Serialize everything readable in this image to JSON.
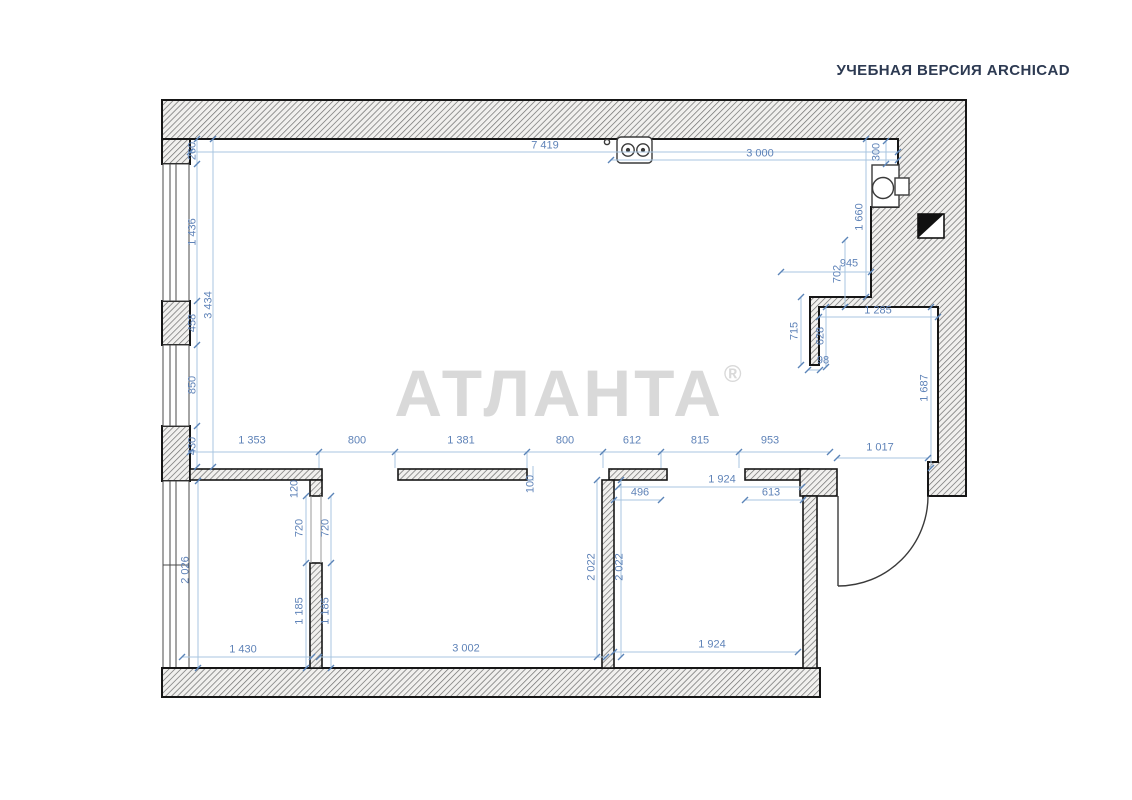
{
  "header": {
    "title": "УЧЕБНАЯ ВЕРСИЯ ARCHICAD"
  },
  "watermark": {
    "text": "АТЛАНТА",
    "mark": "®"
  },
  "colors": {
    "dimension_text": "#5f83b8",
    "dimension_line": "#a9c6e0",
    "wall_outline": "#161616",
    "hatch_line": "#6e6e6e",
    "header_text": "#2d3a52",
    "watermark_gray": "#d9d9d9"
  },
  "icons": {
    "stove": "stove-2-burner-icon",
    "boiler": "boiler-icon",
    "marker": "section-marker-icon",
    "door": "entry-door-arc"
  },
  "dims": {
    "d7419": "7 419",
    "d3000": "3 000",
    "d300": "300",
    "d260": "260",
    "d1436": "1 436",
    "d3434": "3 434",
    "d458": "458",
    "d850": "850",
    "d430": "430",
    "d1353": "1 353",
    "d800a": "800",
    "d1381": "1 381",
    "d800b": "800",
    "d612": "612",
    "d815": "815",
    "d953": "953",
    "d1017": "1 017",
    "d945": "945",
    "d702": "702",
    "d1660": "1 660",
    "d1285": "1 285",
    "d715": "715",
    "d628": "628",
    "d98": "98",
    "d1687": "1 687",
    "d120": "120",
    "d100": "100",
    "d720L": "720",
    "d720R": "720",
    "d1185L": "1 185",
    "d1185R": "1 185",
    "d2026": "2 026",
    "d1430": "1 430",
    "d3002": "3 002",
    "d2022L": "2 022",
    "d2022R": "2 022",
    "d1924t": "1 924",
    "d496": "496",
    "d613": "613",
    "d1924b": "1 924"
  }
}
